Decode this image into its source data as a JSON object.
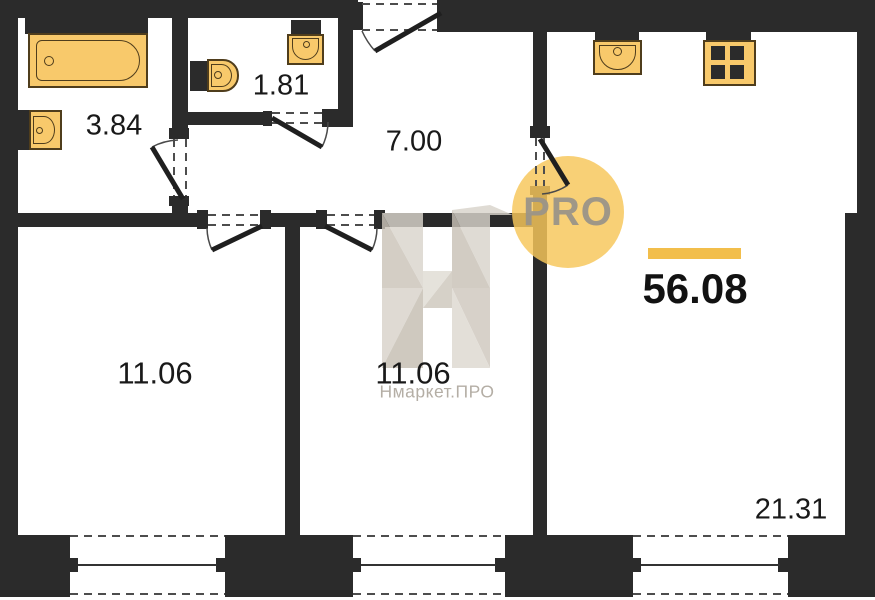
{
  "plan_title": "apartment-floor-plan",
  "total_area": "56.08",
  "rooms": [
    {
      "name": "bathroom",
      "area": "3.84"
    },
    {
      "name": "toilet",
      "area": "1.81"
    },
    {
      "name": "hallway",
      "area": "7.00"
    },
    {
      "name": "room-left",
      "area": "11.06"
    },
    {
      "name": "room-middle",
      "area": "11.06"
    },
    {
      "name": "living-kitchen",
      "area": "21.31"
    }
  ],
  "fixtures": {
    "bathtub": "bathtub",
    "bath_sink": "sink",
    "toilet": "toilet",
    "toilet_sink": "sink",
    "kitchen_sink": "kitchen-sink",
    "stove": "stove-4-burners"
  },
  "watermark": {
    "brand_letter": "Н",
    "brand_text": "Нмаркет.ПРО",
    "badge_text": "PRO"
  },
  "colors": {
    "wall": "#2B2B2B",
    "fixture_fill": "#F8C96B",
    "fixture_outline": "#4F3D1C",
    "accent_bar": "#F2BE4B",
    "badge_circle": "#F7C75A",
    "badge_text": "#9A9388",
    "watermark_fill": "#D6D0C7",
    "watermark_text": "#B4AEA5"
  }
}
